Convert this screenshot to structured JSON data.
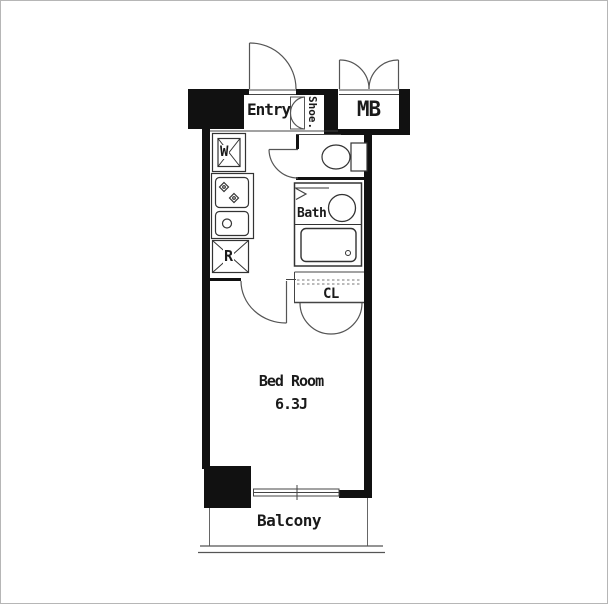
{
  "labels": {
    "entry": "Entry",
    "shoe_closet": "Shoe.",
    "meter_box": "MB",
    "washer": "W",
    "refrigerator": "R",
    "bath": "Bath",
    "closet": "CL",
    "bedroom": "Bed Room",
    "bedroom_size": "6.3J",
    "balcony": "Balcony"
  },
  "colors": {
    "wall": "#111111",
    "thin_line": "#444444",
    "fixture_line": "#333333",
    "background": "#ffffff"
  }
}
